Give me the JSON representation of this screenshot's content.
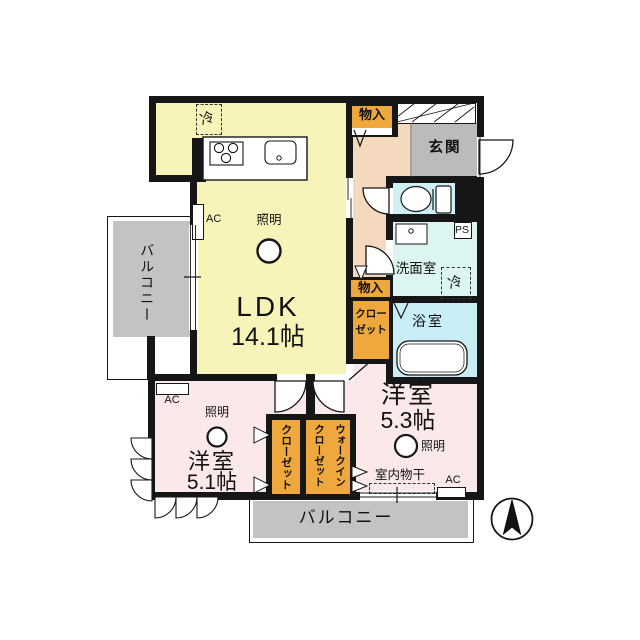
{
  "rooms": {
    "ldk": {
      "label": "LDK",
      "size": "14.1帖"
    },
    "bedroom_51": {
      "label": "洋室",
      "size": "5.1帖"
    },
    "bedroom_53": {
      "label": "洋室",
      "size": "5.3帖"
    },
    "entrance": {
      "label": "玄関"
    },
    "washroom": {
      "label": "洗面室"
    },
    "bathroom": {
      "label": "浴室"
    },
    "balcony_left": {
      "label": "バルコニー"
    },
    "balcony_bottom": {
      "label": "バルコニー"
    }
  },
  "storage": {
    "monoire_top": {
      "label": "物入"
    },
    "monoire_hall": {
      "label": "物入"
    },
    "closet_hall": {
      "label": "クロー\nゼット"
    },
    "closet_bedroom": {
      "label": "クローゼット"
    },
    "walk_in_closet": {
      "label": "ウォークイン\nクローゼット"
    }
  },
  "fixtures": {
    "light": "照明",
    "fridge": "冷",
    "ac": "AC",
    "ps": "PS",
    "indoor_drying": "室内物干"
  },
  "colors": {
    "wall": "#161616",
    "ldk_yellow": "#F8F4B9",
    "bedroom_pink": "#FAE9E8",
    "hallway_peach": "#F5D9BE",
    "entrance_gray": "#BBBBBB",
    "balcony_gray": "#C3C3C3",
    "toilet_cyan": "#CFF1F6",
    "washroom_cyan": "#DDF5F1",
    "bath_cyan": "#C9EDF4",
    "closet_orange": "#EEA83D"
  }
}
